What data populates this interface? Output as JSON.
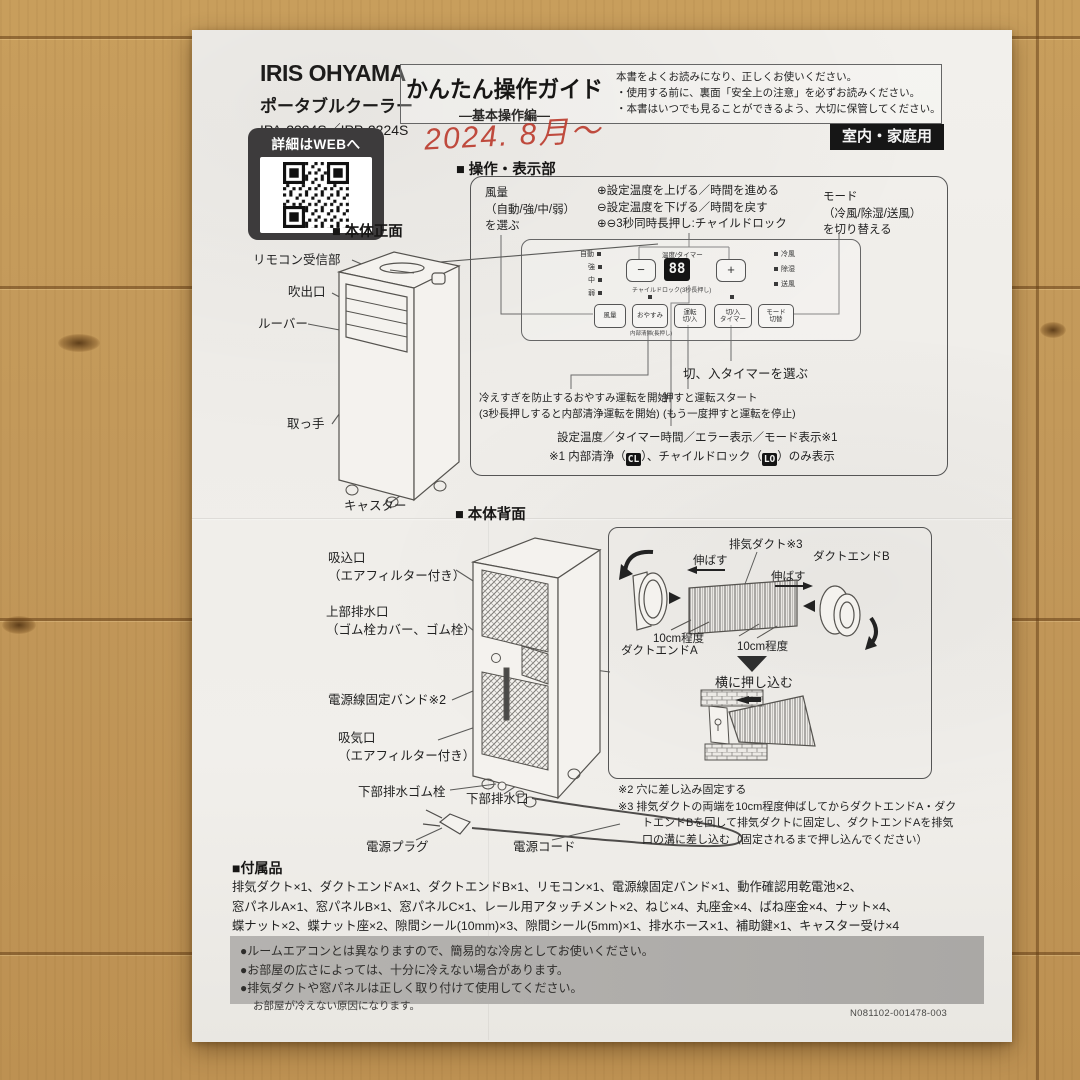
{
  "header": {
    "brand": "IRIS OHYAMA",
    "product": "ポータブルクーラー",
    "models": "IPA-2324S／IPP-2224S",
    "title": "かんたん操作ガイド",
    "subtitle": "―基本操作編―",
    "notices": [
      "本書をよくお読みになり、正しくお使いください。",
      "・使用する前に、裏面「安全上の注意」を必ずお読みください。",
      "・本書はいつでも見ることができるよう、大切に保管してください。"
    ],
    "usage_badge": "室内・家庭用",
    "handwritten_date": "2024. 8月〜",
    "qr_caption": "詳細はWEBへ"
  },
  "controls": {
    "heading": "■ 操作・表示部",
    "fan_note": [
      "風量",
      "（自動/強/中/弱）",
      "を選ぶ"
    ],
    "temp_notes": [
      "⊕設定温度を上げる／時間を進める",
      "⊖設定温度を下げる／時間を戻す",
      "⊕⊖3秒同時長押し:チャイルドロック"
    ],
    "mode_note": [
      "モード",
      "（冷風/除湿/送風）",
      "を切り替える"
    ],
    "panel": {
      "fan_indicators": [
        "自動",
        "強",
        "中",
        "弱"
      ],
      "mode_indicators": [
        "冷風",
        "除湿",
        "送風"
      ],
      "display_label": "温度/タイマー",
      "display_value": "88",
      "minus_label": "−",
      "plus_label": "+",
      "childlock_label": "チャイルドロック(3秒長押し)",
      "buttons": [
        [
          "風量"
        ],
        [
          "おやすみ"
        ],
        [
          "運転",
          "切/入"
        ],
        [
          "切/入",
          "タイマー"
        ],
        [
          "モード",
          "切替"
        ]
      ],
      "sleep_button_sub": "内部清掃(長押し)"
    },
    "timer_note": "切、入タイマーを選ぶ",
    "sleep_note": [
      "冷えすぎを防止するおやすみ運転を開始",
      "(3秒長押しすると内部清浄運転を開始)"
    ],
    "power_note": [
      "押すと運転スタート",
      "(もう一度押すと運転を停止)"
    ],
    "display_note": "設定温度／タイマー時間／エラー表示／モード表示※1",
    "display_footnote": {
      "pre": "※1 内部清浄（",
      "cl": "CL",
      "mid": "）、チャイルドロック（",
      "lo": "LO",
      "post": "）のみ表示"
    }
  },
  "front": {
    "heading": "■ 本体正面",
    "labels": [
      "リモコン受信部",
      "吹出口",
      "ルーバー",
      "取っ手",
      "キャスター"
    ]
  },
  "back": {
    "heading": "■ 本体背面",
    "labels": {
      "inlet": [
        "吸込口",
        "（エアフィルター付き）"
      ],
      "top_drain": [
        "上部排水口",
        "（ゴム栓カバー、ゴム栓）"
      ],
      "cord_band": "電源線固定バンド※2",
      "intake": [
        "吸気口",
        "（エアフィルター付き）"
      ],
      "bottom_plug": "下部排水ゴム栓",
      "bottom_drain": "下部排水口",
      "power_plug": "電源プラグ",
      "power_cord": "電源コード"
    }
  },
  "duct": {
    "duct_label": "排気ダクト※3",
    "end_a": "ダクトエンドA",
    "end_b": "ダクトエンドB",
    "stretch": "伸ばす",
    "length_note": "10cm程度",
    "push_note": "横に押し込む"
  },
  "footnotes": {
    "n2": "※2 穴に差し込み固定する",
    "n3": "※3 排気ダクトの両端を10cm程度伸ばしてからダクトエンドA・ダクトエンドBを回して排気ダクトに固定し、ダクトエンドAを排気口の溝に差し込む（固定されるまで押し込んでください）"
  },
  "accessories": {
    "heading": "■付属品",
    "lines": [
      "排気ダクト×1、ダクトエンドA×1、ダクトエンドB×1、リモコン×1、電源線固定バンド×1、動作確認用乾電池×2、",
      "窓パネルA×1、窓パネルB×1、窓パネルC×1、レール用アタッチメント×2、ねじ×4、丸座金×4、ばね座金×4、ナット×4、",
      "蝶ナット×2、蝶ナット座×2、隙間シール(10mm)×3、隙間シール(5mm)×1、排水ホース×1、補助鍵×1、キャスター受け×4"
    ]
  },
  "cautions": {
    "lines": [
      "●ルームエアコンとは異なりますので、簡易的な冷房としてお使いください。",
      "●お部屋の広さによっては、十分に冷えない場合があります。",
      "●排気ダクトや窓パネルは正しく取り付けて使用してください。"
    ],
    "sub": "お部屋が冷えない原因になります。"
  },
  "doc_code": "N081102-001478-003",
  "colors": {
    "wood": "#c49a58",
    "paper": "#f0eeea",
    "badge_bg": "#161616",
    "handwriting_red": "#bb3a2c",
    "ink": "#2b2a28"
  }
}
